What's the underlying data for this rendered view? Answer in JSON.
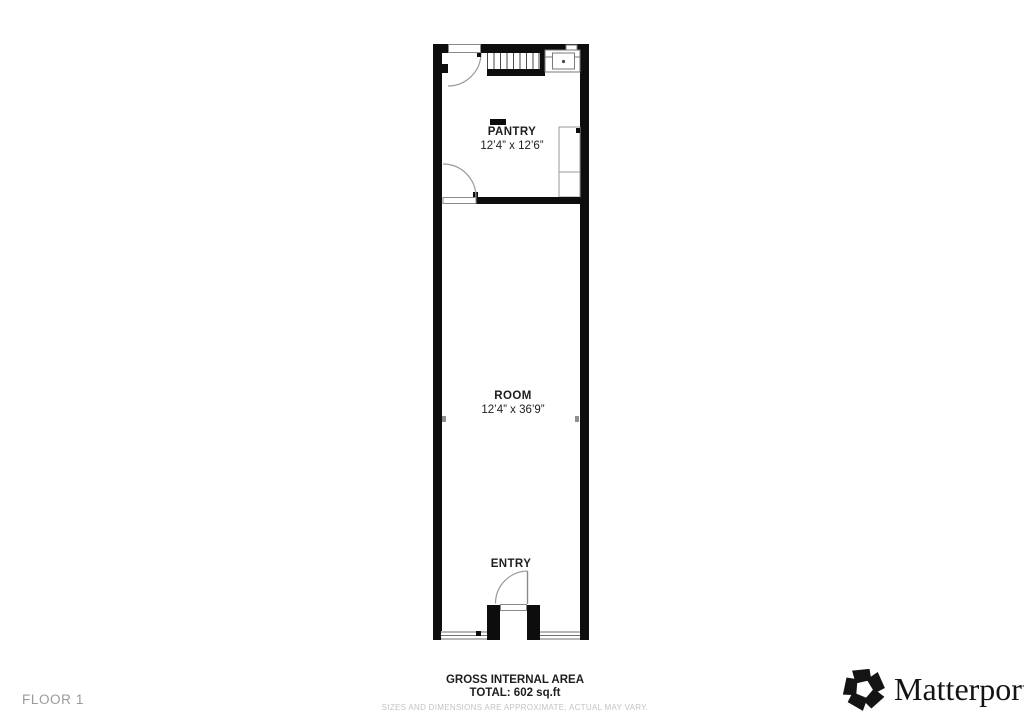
{
  "floor": {
    "label": "FLOOR 1"
  },
  "rooms": [
    {
      "name": "PANTRY",
      "dimensions": "12’4” x 12’6”"
    },
    {
      "name": "ROOM",
      "dimensions": "12’4” x 36’9”"
    },
    {
      "name": "ENTRY",
      "dimensions": ""
    }
  ],
  "area_summary": {
    "title": "GROSS INTERNAL AREA",
    "total": "TOTAL: 602 sq.ft",
    "disclaimer": "SIZES AND DIMENSIONS ARE APPROXIMATE, ACTUAL MAY VARY."
  },
  "brand": {
    "name": "Matterport",
    "registered_mark": "®"
  },
  "icons": {
    "logo": "matterport-pinwheel-icon"
  },
  "colors": {
    "wall": "#0d0d0d",
    "thin_line": "#808080",
    "label_text": "#1e1e1e",
    "muted_text": "#c3c3c3",
    "floor_label_text": "#9b9b9b",
    "brand_text": "#141414"
  }
}
